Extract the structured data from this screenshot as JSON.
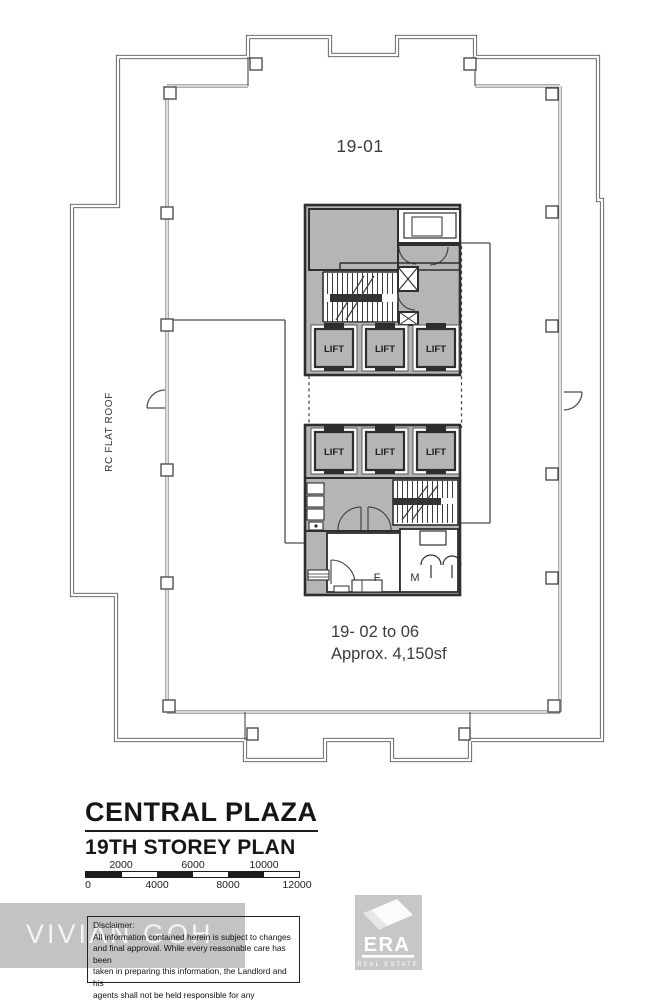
{
  "plan": {
    "unit_label_top": "19-01",
    "unit_label_bottom_line1": "19- 02 to 06",
    "unit_label_bottom_line2": "Approx. 4,150sf",
    "roof_label": "RC FLAT ROOF",
    "lift_label": "LIFT",
    "toilet_female": "F",
    "toilet_male": "M"
  },
  "title_block": {
    "building_name": "CENTRAL PLAZA",
    "plan_name": "19TH STOREY PLAN"
  },
  "scale_bar": {
    "top_labels": [
      "2000",
      "6000",
      "10000"
    ],
    "bottom_labels": [
      "0",
      "4000",
      "8000",
      "12000"
    ]
  },
  "disclaimer": {
    "heading": "Disclaimer:",
    "lines": [
      "All information contained herein is subject to changes",
      "and final approval. While every reasonable care has been",
      "taken in preparing this information, the Landlord and his",
      "agents shall not be held responsible for any inaccuracy."
    ]
  },
  "watermark": {
    "text": "VIVIAN GOH"
  },
  "logo": {
    "brand": "ERA",
    "tagline": "REAL ESTATE"
  },
  "colors": {
    "core_fill": "#b5b5b5",
    "boundary_line": "#585858",
    "wall_line": "#2e2e2e",
    "band_gray": "#c3c3c3",
    "logo_gray": "#c7c7c7",
    "scale_black": "#1c1c1c"
  }
}
